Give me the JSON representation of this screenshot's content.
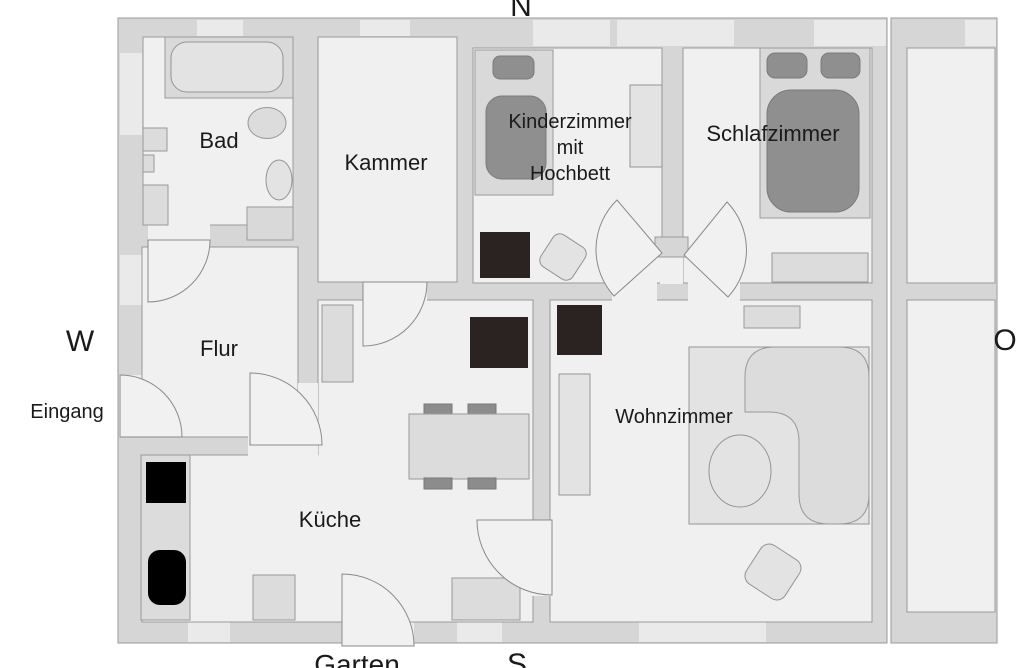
{
  "compass": {
    "north": "N",
    "west": "W",
    "east": "O",
    "south": "S"
  },
  "annotations": {
    "entrance": "Eingang",
    "garden": "Garten"
  },
  "rooms": {
    "bad": {
      "name": "Bad"
    },
    "kammer": {
      "name": "Kammer"
    },
    "kinderzimmer": {
      "name": "Kinderzimmer mit Hochbett",
      "lines": [
        "Kinderzimmer",
        "mit",
        "Hochbett"
      ]
    },
    "schlafzimmer": {
      "name": "Schlafzimmer"
    },
    "flur": {
      "name": "Flur"
    },
    "kueche": {
      "name": "Küche"
    },
    "wohnzimmer": {
      "name": "Wohnzimmer"
    }
  },
  "furniture": {
    "bad": [
      "bathtub",
      "washbasin",
      "toilet",
      "radiator",
      "shower-tray"
    ],
    "kinderzimmer": [
      "loft-bed-with-pillow",
      "wardrobe",
      "dark-cabinet",
      "chair"
    ],
    "schlafzimmer": [
      "double-bed-two-pillows",
      "sideboard"
    ],
    "flur": [
      "hall-cabinet"
    ],
    "kueche": [
      "counter-with-stove-and-sink",
      "dining-table-four-chairs",
      "dark-cabinet",
      "two-low-cabinets"
    ],
    "wohnzimmer": [
      "corner-sofa",
      "round-coffee-table",
      "armchair",
      "rug",
      "bookshelf",
      "dark-cabinet",
      "wall-shelf"
    ]
  },
  "doors": [
    "entrance-door",
    "bad-door",
    "flur-kueche-door",
    "kammer-door",
    "hall-left-door",
    "hall-right-door",
    "kueche-wohnzimmer-door",
    "garden-door"
  ],
  "colors": {
    "wall": "#d6d6d6",
    "floor": "#f0f0f0",
    "window": "#eaeaea",
    "furniture_light": "#dcdcdc",
    "bed_gray": "#8f8f8f",
    "dark_item": "#2b2321",
    "appliance_black": "#000000",
    "outline": "#9a9a9a",
    "text": "#1a1a1a",
    "background": "#ffffff"
  }
}
